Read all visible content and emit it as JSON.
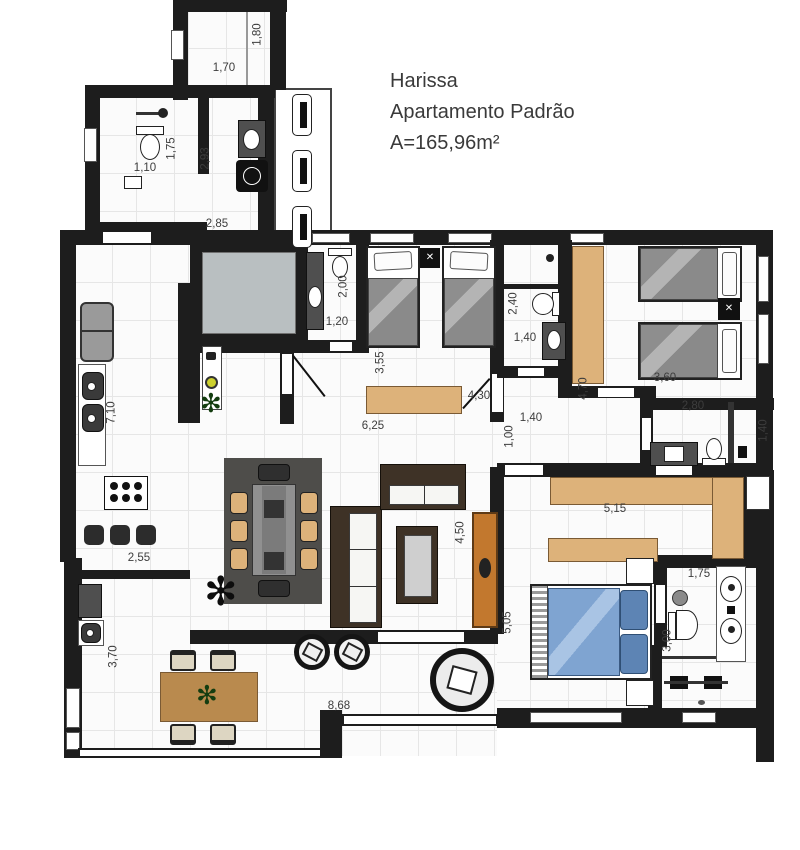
{
  "title": {
    "name": "Harissa",
    "type": "Apartamento Padrão",
    "area": "A=165,96m²"
  },
  "dims": [
    "1,70",
    "1,80",
    "1,75",
    "1,10",
    "2,93",
    "2,85",
    "2,00",
    "1,20",
    "3,55",
    "4,30",
    "6,25",
    "2,40",
    "1,40",
    "4,70",
    "3,60",
    "1,40",
    "1,00",
    "2,80",
    "1,40",
    "7,10",
    "2,55",
    "4,50",
    "5,15",
    "5,05",
    "1,75",
    "3,00",
    "3,70",
    "8,68"
  ],
  "colors": {
    "wall": "#1d1d1d",
    "floor": "#fbfbfb",
    "grid": "#e6e6e6",
    "wood": "#ddb27a",
    "sideboard": "#c2782e",
    "bedBlue": "#7fa4d1",
    "pillowBlue": "#5d84b4",
    "rug": "#4e4d4a",
    "shaft": "#b9bfc1",
    "appliance": "#4f4f4f"
  }
}
